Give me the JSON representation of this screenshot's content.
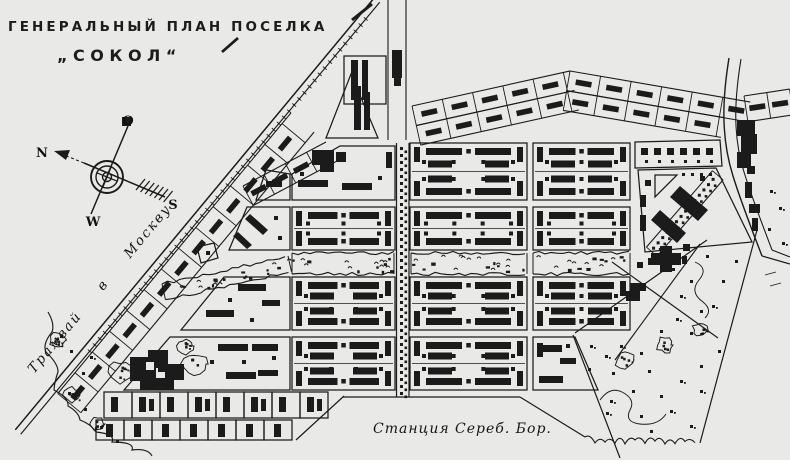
{
  "map": {
    "title": {
      "line1": "ГЕНЕРАЛЬНЫЙ ПЛАН ПОСЕЛКА",
      "line2": "„СОКОЛ“"
    },
    "labels": {
      "tram_road": "Трамвай в Москву",
      "station": "Станция Сереб. Бор."
    },
    "compass": {
      "north": "N",
      "east": "O",
      "south": "S",
      "west": "W"
    },
    "colors": {
      "ink": "#1b1b1b",
      "paper": "#e9e9e7"
    }
  }
}
